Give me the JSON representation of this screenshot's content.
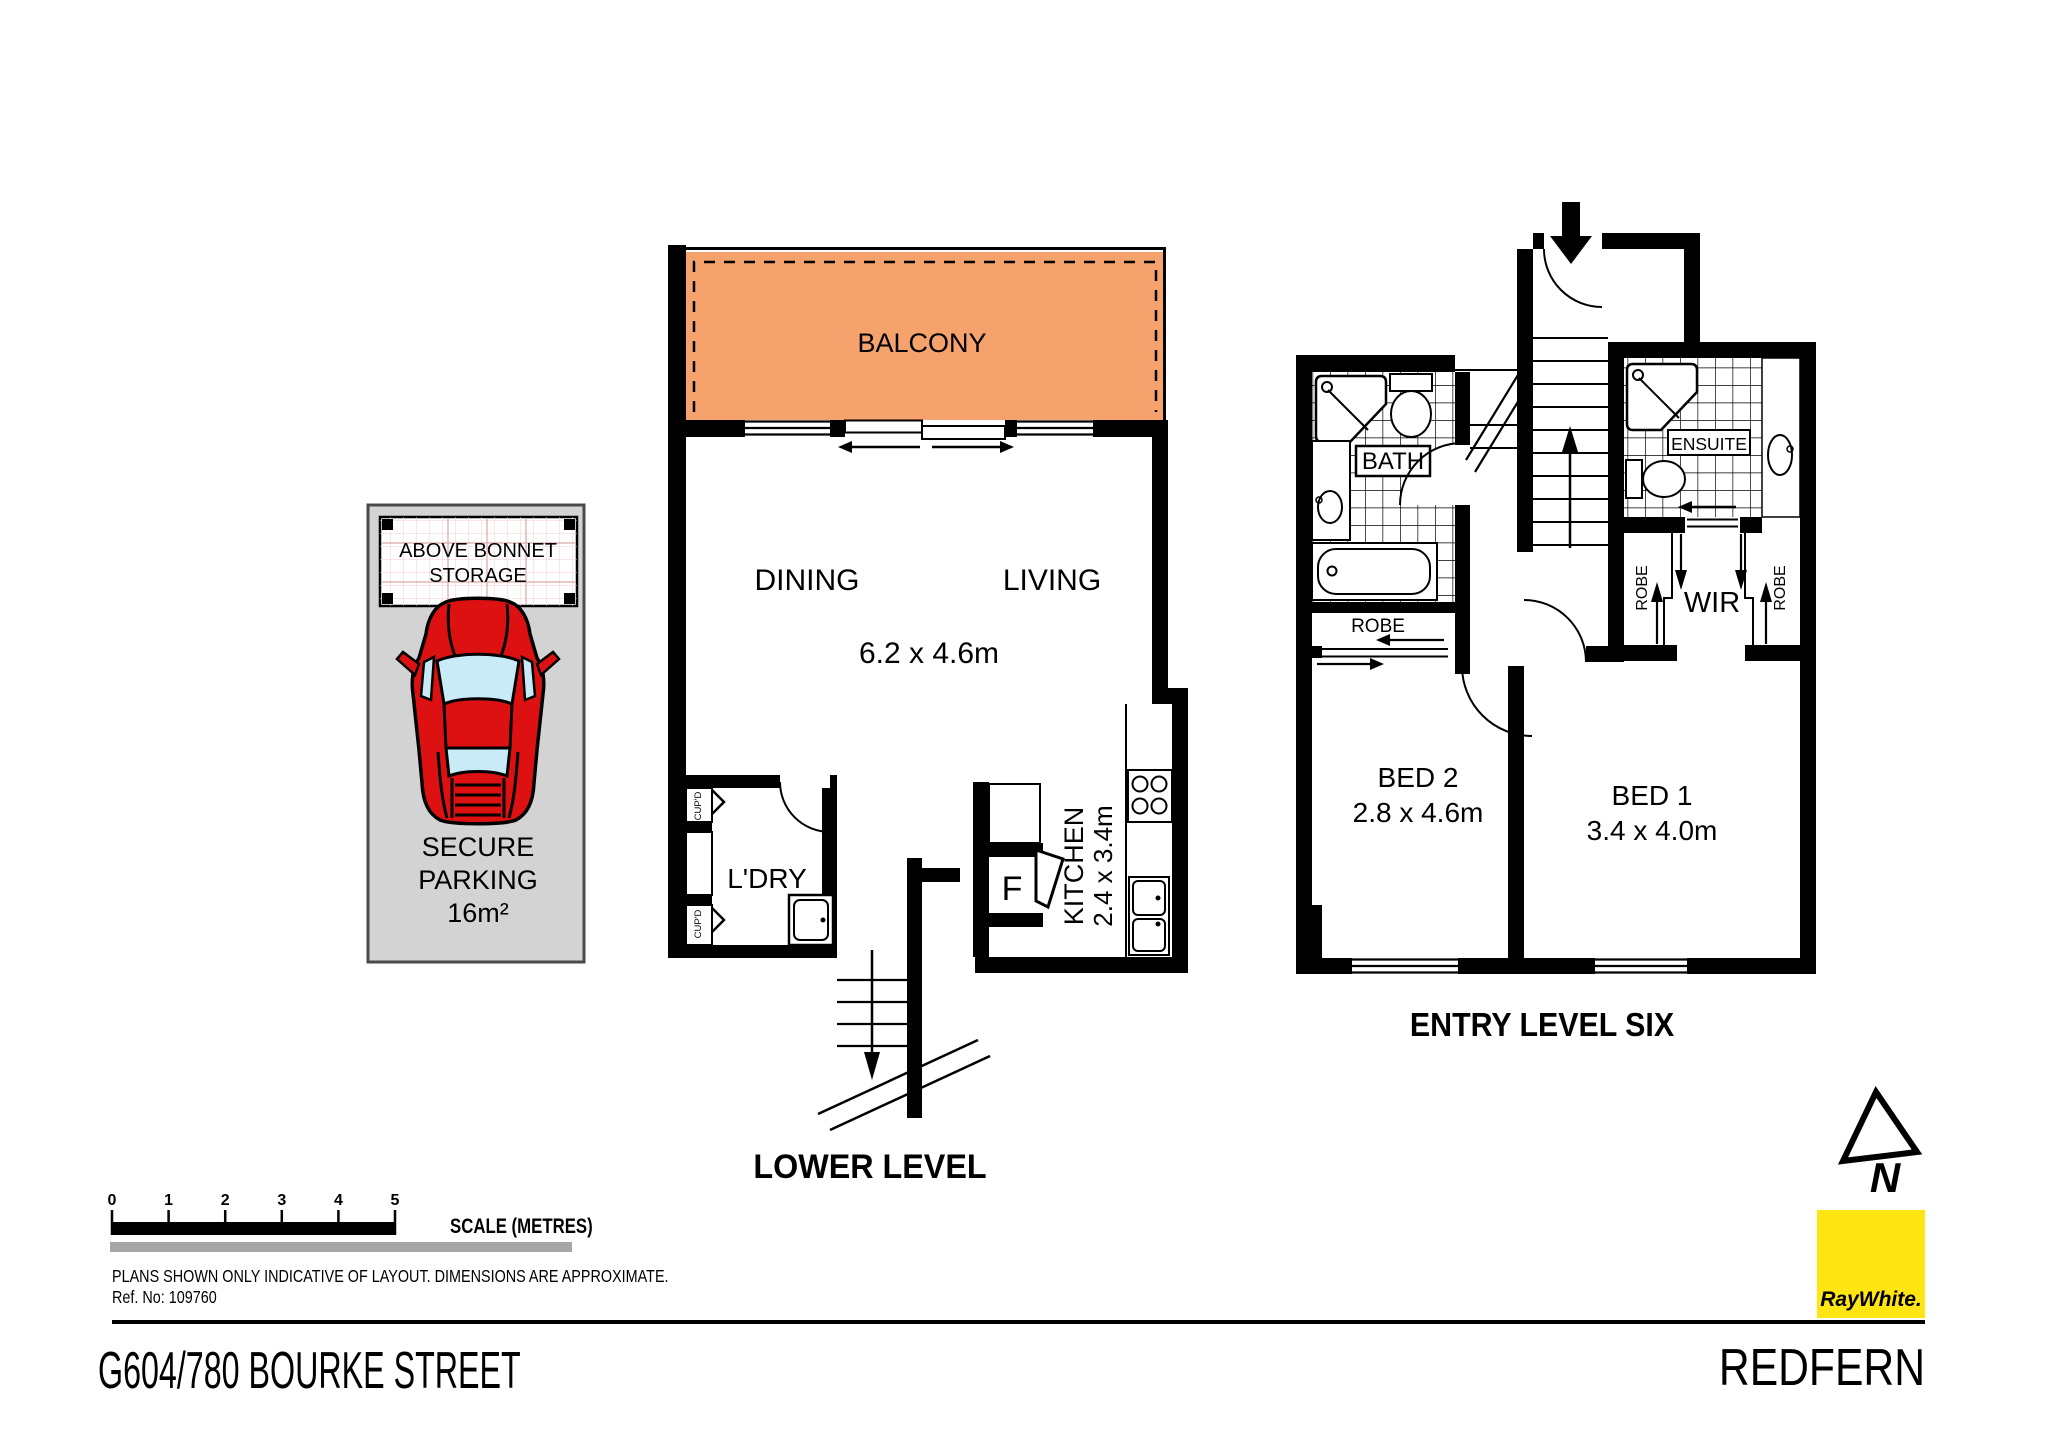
{
  "colors": {
    "balcony": "#F5A26C",
    "car_red": "#DD1111",
    "glass": "#C9EAF7",
    "parking_gray": "#D3D3D3",
    "logo_yellow": "#FFE512",
    "logo_text_gray": "#575756"
  },
  "lower_level": {
    "title": "LOWER LEVEL",
    "balcony": "BALCONY",
    "dining": "DINING",
    "living": "LIVING",
    "living_dims": "6.2 x 4.6m",
    "kitchen": "KITCHEN",
    "kitchen_dims": "2.4 x 3.4m",
    "fridge": "F",
    "laundry": "L'DRY",
    "cupboard": "CUP'D"
  },
  "entry_level": {
    "title": "ENTRY LEVEL SIX",
    "bath": "BATH",
    "ensuite": "ENSUITE",
    "robe": "ROBE",
    "wir": "WIR",
    "bed2": "BED 2",
    "bed2_dims": "2.8 x 4.6m",
    "bed1": "BED 1",
    "bed1_dims": "3.4 x 4.0m"
  },
  "parking": {
    "sign_line1": "ABOVE BONNET",
    "sign_line2": "STORAGE",
    "label_line1": "SECURE",
    "label_line2": "PARKING",
    "label_line3": "16m²"
  },
  "scale_bar": {
    "ticks": [
      "0",
      "1",
      "2",
      "3",
      "4",
      "5"
    ],
    "label": "SCALE (METRES)"
  },
  "footer": {
    "disclaimer": "PLANS SHOWN ONLY INDICATIVE OF LAYOUT.  DIMENSIONS ARE APPROXIMATE.",
    "ref": "Ref. No: 109760",
    "address": "G604/780 BOURKE STREET",
    "suburb": "REDFERN"
  },
  "branding": {
    "logo_text": "RayWhite.",
    "compass_n": "N"
  }
}
